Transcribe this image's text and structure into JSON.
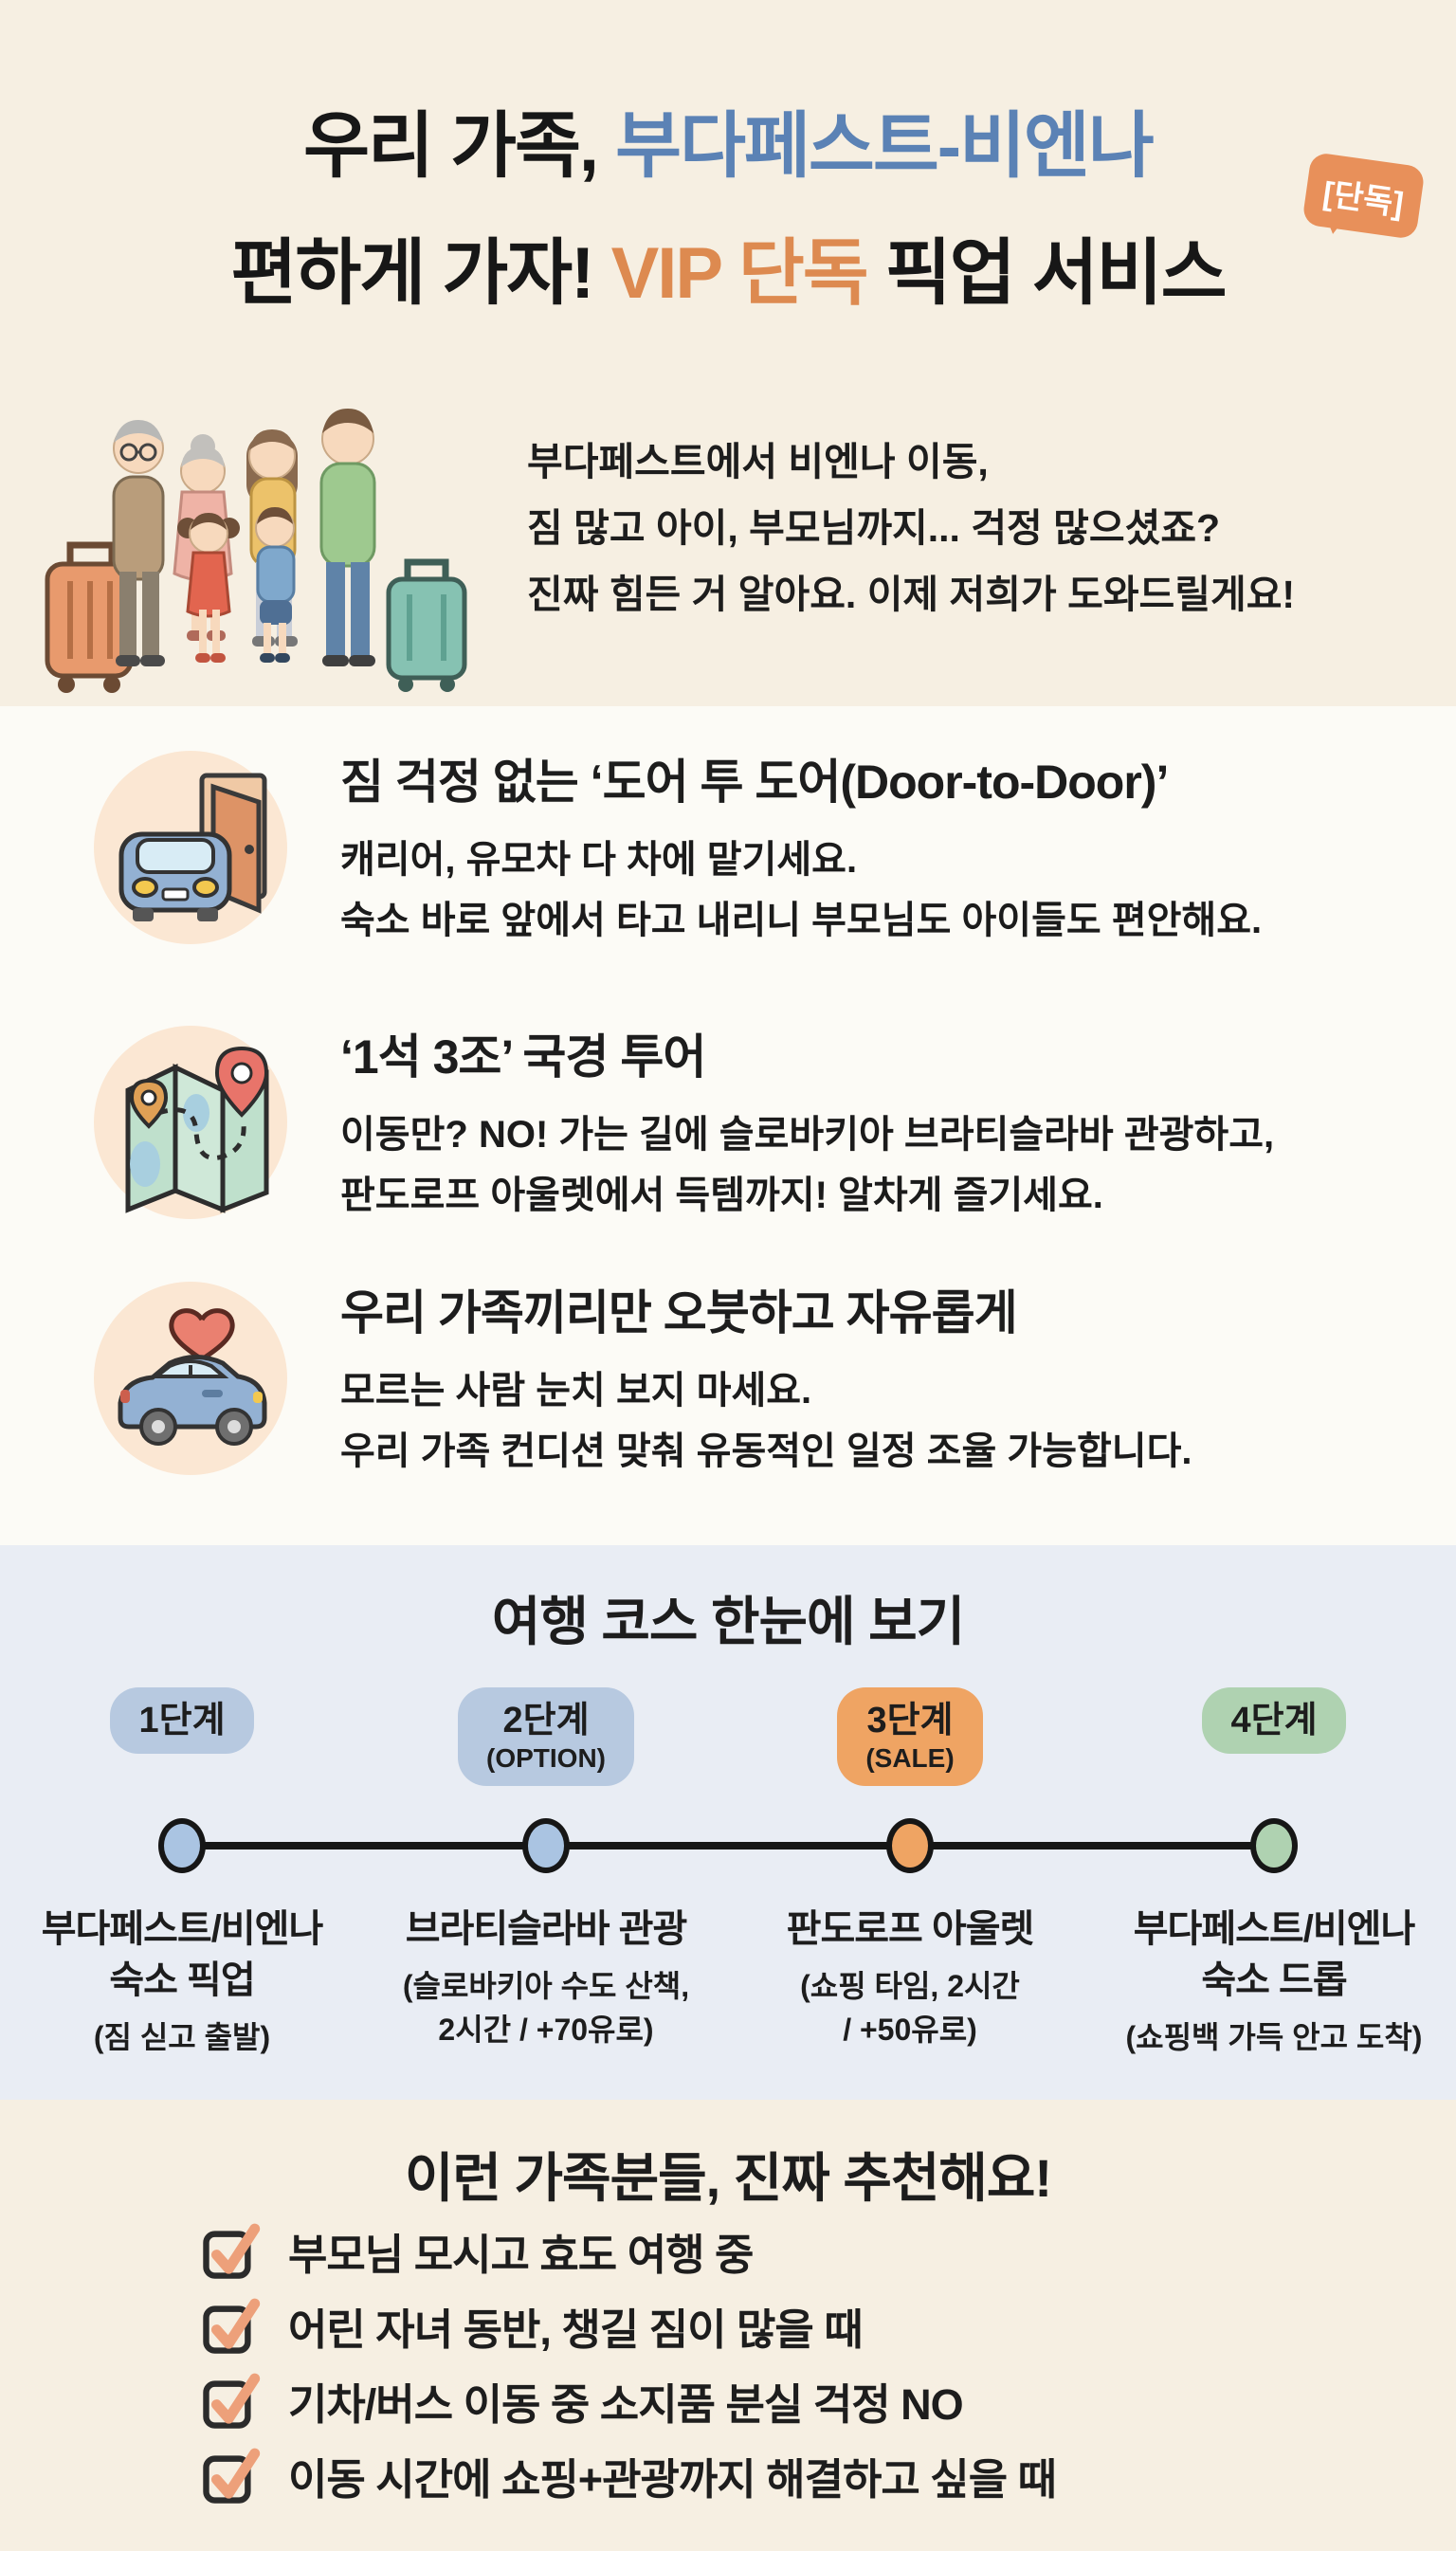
{
  "colors": {
    "accent_blue": "#5b82b5",
    "accent_orange": "#dd8a50",
    "hero_bg": "#f6efe2",
    "course_bg": "#e9edf4",
    "icon_circle_bg": "#fbe7d3",
    "check_orange": "#eda07a"
  },
  "badge": {
    "label": "[단독]"
  },
  "hero": {
    "title_line1_black": "우리 가족, ",
    "title_line1_blue": "부다페스트-비엔나",
    "title_line2_black1": "편하게 가자! ",
    "title_line2_orange": "VIP 단독",
    "title_line2_black2": " 픽업 서비스",
    "intro_line1": "부다페스트에서 비엔나 이동,",
    "intro_line2": "짐 많고 아이, 부모님까지... 걱정 많으셨죠?",
    "intro_line3": "진짜 힘든 거 알아요. 이제 저희가 도와드릴게요!"
  },
  "features": [
    {
      "icon": "car-door-icon",
      "title": "짐 걱정 없는 ‘도어 투 도어(Door-to-Door)’",
      "line1": "캐리어, 유모차 다 차에 맡기세요.",
      "line2": "숙소 바로 앞에서 타고 내리니 부모님도 아이들도 편안해요."
    },
    {
      "icon": "map-pins-icon",
      "title": "‘1석 3조’ 국경 투어",
      "line1": "이동만? NO! 가는 길에 슬로바키아 브라티슬라바 관광하고,",
      "line2": "판도로프 아울렛에서 득템까지! 알차게 즐기세요."
    },
    {
      "icon": "heart-car-icon",
      "title": "우리 가족끼리만 오붓하고 자유롭게",
      "line1": "모르는 사람 눈치 보지 마세요.",
      "line2": "우리 가족 컨디션 맞춰 유동적인 일정 조율 가능합니다."
    }
  ],
  "course": {
    "title": "여행 코스 한눈에 보기",
    "steps": [
      {
        "stage": "1단계",
        "tag": "",
        "pill_color": "#b7c9e0",
        "dot_color": "#aac4e2",
        "name1": "부다페스트/비엔나",
        "name2": "숙소 픽업",
        "detail1": "(짐 싣고 출발)",
        "detail2": ""
      },
      {
        "stage": "2단계",
        "tag": "(OPTION)",
        "pill_color": "#b7c9e0",
        "dot_color": "#aac4e2",
        "name1": "브라티슬라바 관광",
        "name2": "",
        "detail1": "(슬로바키아 수도 산책,",
        "detail2": "2시간 / +70유로)"
      },
      {
        "stage": "3단계",
        "tag": "(SALE)",
        "pill_color": "#efa463",
        "dot_color": "#efa463",
        "name1": "판도로프 아울렛",
        "name2": "",
        "detail1": "(쇼핑 타임, 2시간",
        "detail2": "/ +50유로)"
      },
      {
        "stage": "4단계",
        "tag": "",
        "pill_color": "#afd2b1",
        "dot_color": "#afd2b1",
        "name1": "부다페스트/비엔나",
        "name2": "숙소 드롭",
        "detail1": "(쇼핑백 가득 안고 도착)",
        "detail2": ""
      }
    ]
  },
  "recommend": {
    "title": "이런 가족분들, 진짜 추천해요!",
    "items": [
      "부모님 모시고 효도 여행 중",
      "어린 자녀 동반, 챙길 짐이 많을 때",
      "기차/버스 이동 중 소지품 분실 걱정 NO",
      "이동 시간에 쇼핑+관광까지 해결하고 싶을 때"
    ]
  }
}
